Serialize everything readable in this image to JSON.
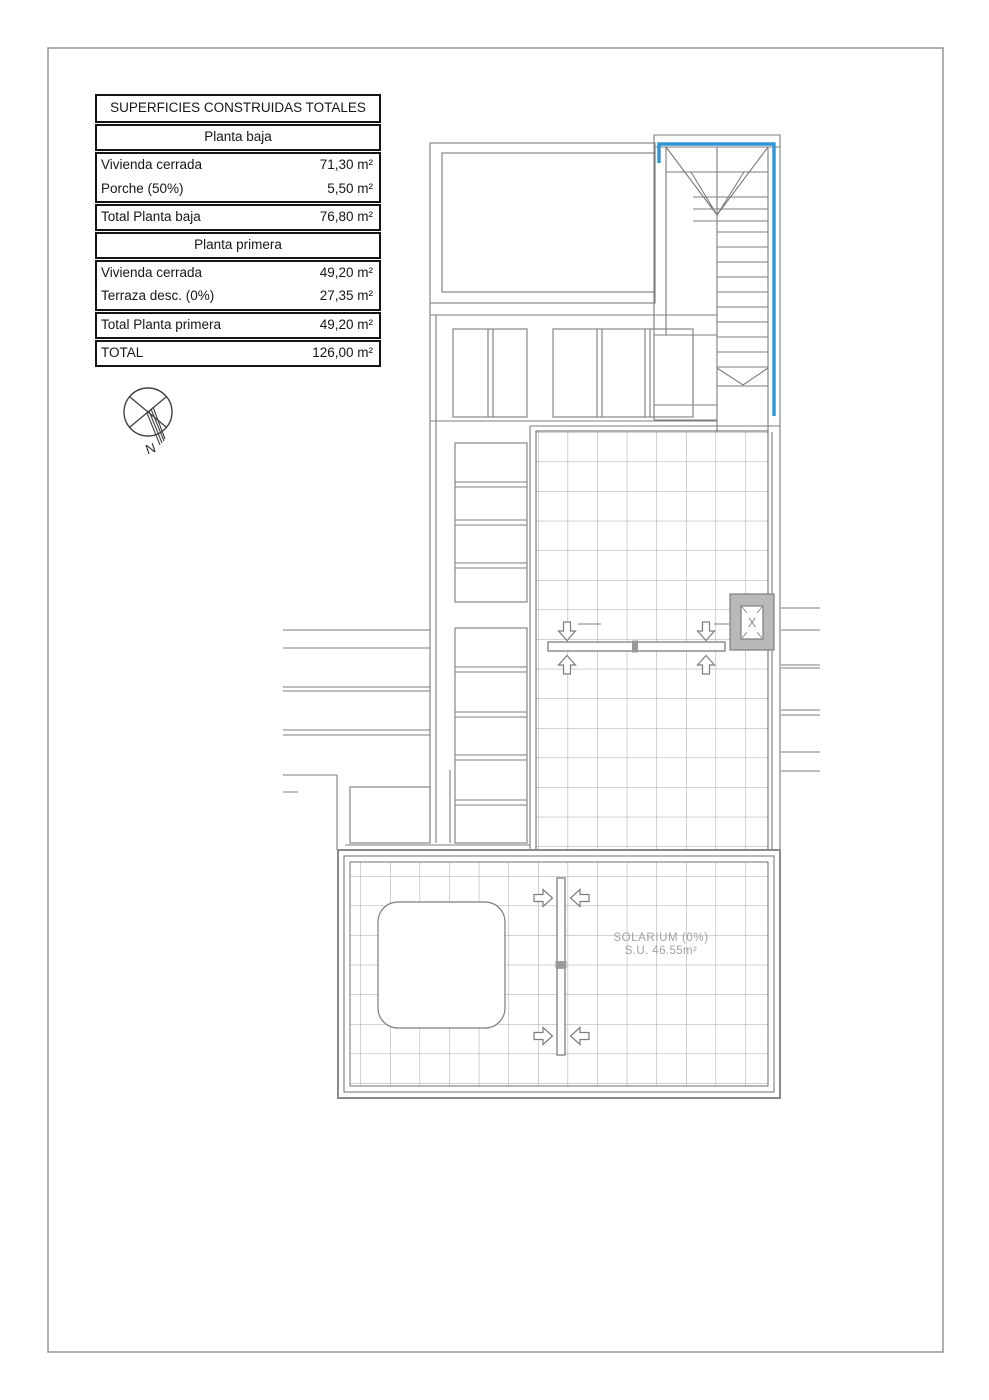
{
  "table": {
    "title": "SUPERFICIES CONSTRUIDAS TOTALES",
    "rows": [
      {
        "kind": "section",
        "label": "Planta baja"
      },
      {
        "kind": "data",
        "label": "Vivienda cerrada",
        "value": "71,30 m²"
      },
      {
        "kind": "data",
        "label": "Porche (50%)",
        "value": "5,50 m²"
      },
      {
        "kind": "total",
        "label": "Total Planta baja",
        "value": "76,80 m²"
      },
      {
        "kind": "section",
        "label": "Planta primera"
      },
      {
        "kind": "data",
        "label": "Vivienda cerrada",
        "value": "49,20 m²"
      },
      {
        "kind": "data",
        "label": "Terraza desc. (0%)",
        "value": "27,35 m²"
      },
      {
        "kind": "total",
        "label": "Total Planta primera",
        "value": "49,20 m²"
      },
      {
        "kind": "total",
        "label": "TOTAL",
        "value": "126,00 m²"
      }
    ]
  },
  "compass": {
    "north_label": "N"
  },
  "plan": {
    "solarium_label": {
      "line1": "SOLARIUM (0%)",
      "line2": "S.U. 46.55m²"
    },
    "chimney_marker": "X"
  },
  "colors": {
    "structure_line": "#7c7c7c",
    "grid_line": "#a3a3a3",
    "highlight_blue": "#2e96d8",
    "chimney_fill": "#b9b9b9",
    "table_border": "#141414",
    "muted_text": "#a2a2a2",
    "page_border": "#9b9b9b"
  }
}
